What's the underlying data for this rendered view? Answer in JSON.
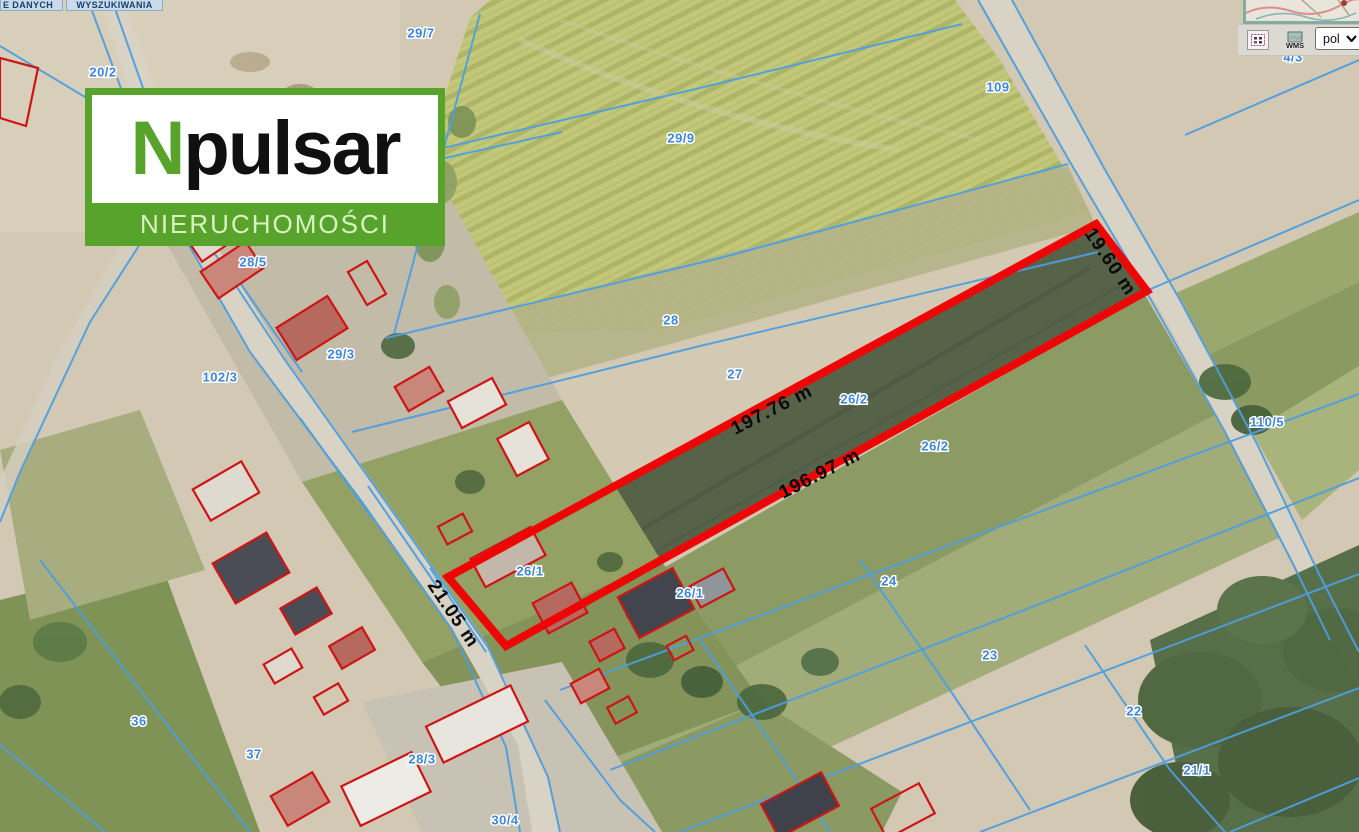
{
  "tabs": {
    "items": [
      {
        "label": "E DANYCH"
      },
      {
        "label": "WYSZUKIWANIA"
      }
    ]
  },
  "logo": {
    "initial": "N",
    "name_rest": "pulsar",
    "subtitle": "NIERUCHOMOŚCI",
    "brand_green": "#58a32c"
  },
  "toolbar": {
    "wms_label": "WMS",
    "language_value": "pol"
  },
  "map": {
    "colors": {
      "cadastral_line": "#4d9fe0",
      "parcel_label": "#3f86d8",
      "highlight_outline": "#ee0606",
      "building_outline": "#cf1414"
    },
    "dimension_labels": [
      {
        "text": "19.60 m",
        "x": 1110,
        "y": 262,
        "rotate": 56
      },
      {
        "text": "197.76 m",
        "x": 772,
        "y": 410,
        "rotate": -27
      },
      {
        "text": "196.97 m",
        "x": 820,
        "y": 474,
        "rotate": -27
      },
      {
        "text": "21.05 m",
        "x": 453,
        "y": 614,
        "rotate": 56
      }
    ],
    "parcel_labels": [
      {
        "text": "29/7",
        "x": 421,
        "y": 33
      },
      {
        "text": "20/2",
        "x": 103,
        "y": 72
      },
      {
        "text": "29/9",
        "x": 681,
        "y": 138
      },
      {
        "text": "109",
        "x": 998,
        "y": 87
      },
      {
        "text": "4/3",
        "x": 1293,
        "y": 57
      },
      {
        "text": "28/5",
        "x": 253,
        "y": 262
      },
      {
        "text": "29/3",
        "x": 341,
        "y": 354
      },
      {
        "text": "102/3",
        "x": 220,
        "y": 377
      },
      {
        "text": "28",
        "x": 671,
        "y": 320
      },
      {
        "text": "27",
        "x": 735,
        "y": 374
      },
      {
        "text": "26/2",
        "x": 854,
        "y": 399
      },
      {
        "text": "26/2",
        "x": 935,
        "y": 446
      },
      {
        "text": "110/5",
        "x": 1267,
        "y": 422
      },
      {
        "text": "26/1",
        "x": 530,
        "y": 571
      },
      {
        "text": "26/1",
        "x": 690,
        "y": 593
      },
      {
        "text": "24",
        "x": 889,
        "y": 581
      },
      {
        "text": "23",
        "x": 990,
        "y": 655
      },
      {
        "text": "22",
        "x": 1134,
        "y": 711
      },
      {
        "text": "21/1",
        "x": 1197,
        "y": 770
      },
      {
        "text": "36",
        "x": 139,
        "y": 721
      },
      {
        "text": "37",
        "x": 254,
        "y": 754
      },
      {
        "text": "28/3",
        "x": 422,
        "y": 759
      },
      {
        "text": "30/4",
        "x": 505,
        "y": 820
      }
    ]
  }
}
